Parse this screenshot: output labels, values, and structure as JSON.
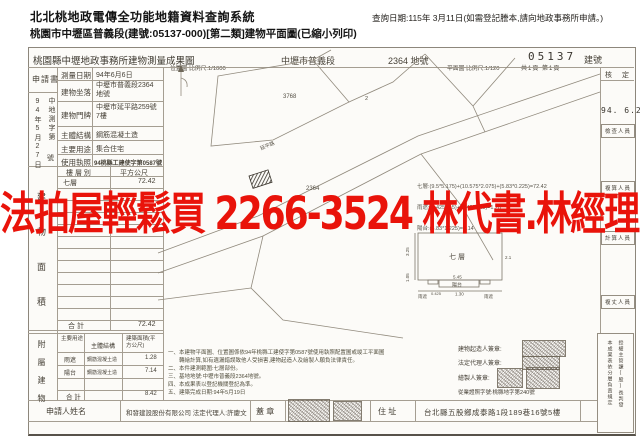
{
  "header": {
    "system_title": "北北桃地政電傳全功能地籍資料查詢系統",
    "query_date": "查詢日期:115年 3月11日(如需登記謄本,請向地政事務所申請。)",
    "subtitle": "桃園市中壢區普義段(建號:05137-000)[第二類]建物平面圖(已縮小列印)"
  },
  "doc": {
    "title": "桃園縣中壢地政事務所建物測量成果圖",
    "district": "中壢市普義段",
    "parcel_no": "2364 地號",
    "building_no": "05137",
    "building_no_label": "建號",
    "scale_location": "位置圖 比例尺:1/1000",
    "scale_plan": "平面圖 比例尺:1/120",
    "page_info": "共1頁 第1頁",
    "application": {
      "label": "申請書",
      "date_vertical": "94年5月27日",
      "doc_no_top": "中地測字第",
      "doc_no_bottom": "號"
    },
    "info_rows": [
      {
        "label": "測量日期",
        "value": "94年6月6日"
      },
      {
        "label": "建物坐落",
        "value": "中壢市普義段2364地號"
      },
      {
        "label": "建物門牌",
        "value": "中壢市延平路259號7樓"
      },
      {
        "label": "主體結構",
        "value": "鋼筋混凝土造"
      },
      {
        "label": "主要用途",
        "value": "集合住宅"
      },
      {
        "label": "使用執照",
        "value": "94桃縣工建使字第0587號"
      }
    ],
    "floor_table": {
      "side_label": "建物面積",
      "header_floor": "樓 層 別",
      "header_area": "平方公尺",
      "floor": "七層",
      "area": "72.42",
      "total_label": "合  計",
      "total": "72.42"
    },
    "annex_table": {
      "side_label": "附屬建物",
      "h_use": "主要用途",
      "h_structure": "主體結構",
      "h_area": "建築面積(平方公尺)",
      "rows": [
        {
          "use": "雨遮",
          "structure": "鋼筋混凝土造",
          "area": "1.28"
        },
        {
          "use": "陽台",
          "structure": "鋼筋混凝土造",
          "area": "7.14"
        }
      ],
      "total_label": "合  計",
      "total": "8.42"
    },
    "applicant": {
      "label": "申請人姓名",
      "name": "和發建設股份有限公司  法定代理人:許慶文",
      "seal": "蓋  章",
      "addr_label": "住  址",
      "address": "台北縣五股鄉成泰路1段189巷16號5樓"
    },
    "map": {
      "parcel_a": "3768",
      "parcel_b": "2364",
      "parcel_c": "2",
      "road_name": "延平路"
    },
    "plan": {
      "formula_1": "七層:(9.5*5.175)+(10.575*2.075)+(5.83*0.225)=72.42",
      "formula_2": "雨遮:(0.425*1.5)+(0.425*1.5)=1.28",
      "formula_3": "陽台:(5.83*1.225)=7.14",
      "room": "七層",
      "balcony": "陽台",
      "canopy_left": "雨遮",
      "canopy_right": "雨遮",
      "dims": [
        "3.25",
        "1.05",
        "0.425",
        "5.45",
        "1.30",
        "2.1"
      ]
    },
    "notes": [
      "一、本建物平面圖、位置圖係依94年桃縣工建使字第0587號使用執照配置圖或竣工平面圖",
      "　　轉繪計算,如有遺漏錯誤致他人受損害,建物起造人及繪製人願負法律責任。",
      "二、本件建測範圍:七層部份。",
      "三、基地地號:中壢市普義段2364地號。",
      "四、本成果表以登記機關登記為準。",
      "五、建築完成日期:94年5月19日"
    ],
    "signatures": {
      "builder": "建物起造人簽章:",
      "legal": "法定代理人簽章:",
      "drafter": "繪製人簽章:",
      "license": "從業證照字號:桃縣地字第240號"
    },
    "approval": {
      "label": "核  定",
      "date": "94. 6.27",
      "officer_1": "檢查人員",
      "officer_2": "複算人員",
      "officer_3": "計算人員",
      "officer_4": "複丈人員"
    },
    "right_note": {
      "col1": "本成果表依分層負責規定",
      "col2": "授權主管課(股)長判發"
    }
  },
  "watermark": {
    "text": "法拍屋輕鬆買 2266-3524 林代書.林經理",
    "color": "#e9130a"
  }
}
